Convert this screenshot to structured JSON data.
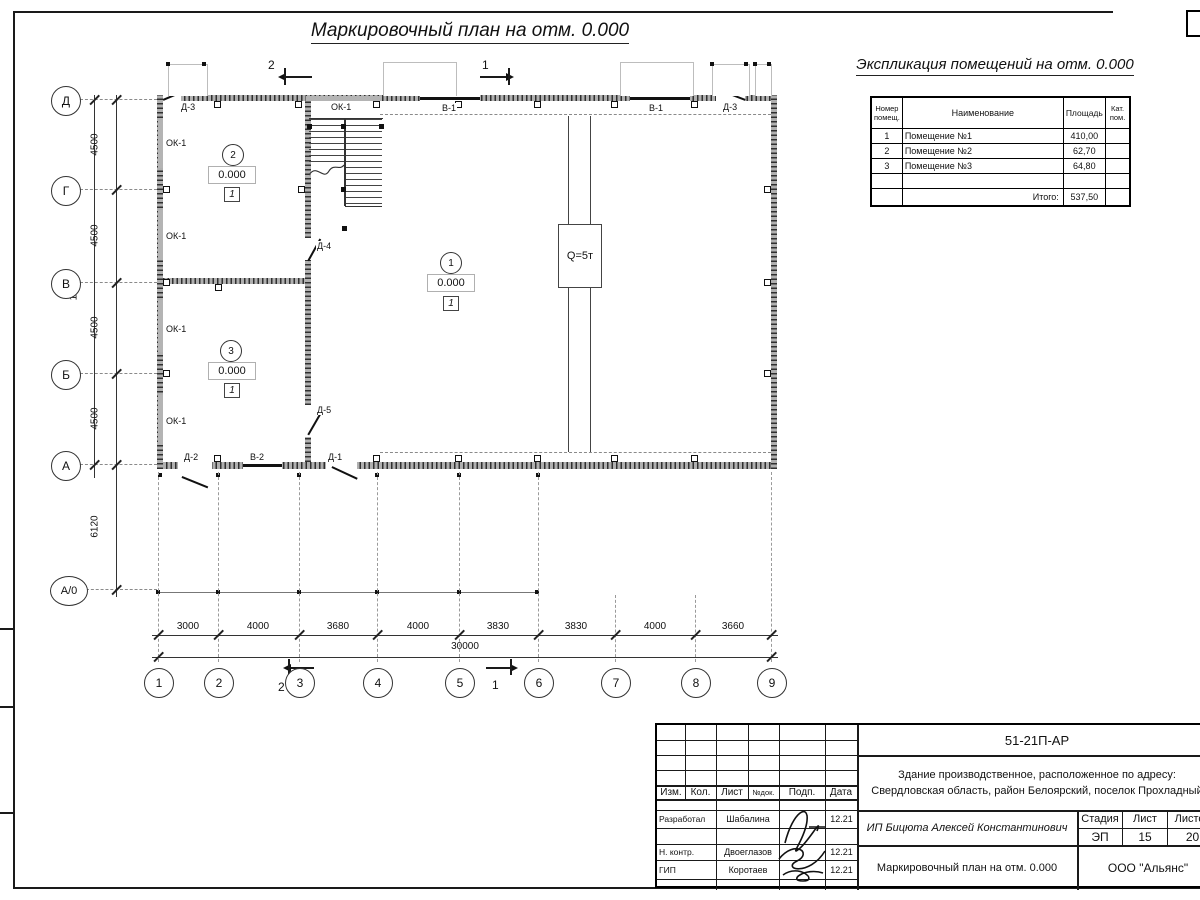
{
  "sheet": {
    "plan_title": "Маркировочный план на отм. 0.000",
    "explication_title": "Экспликация помещений на отм. 0.000"
  },
  "explication": {
    "headers": {
      "num": "Номер помещ.",
      "name": "Наименование",
      "area": "Площадь",
      "cat": "Кат. пом."
    },
    "rows": [
      {
        "num": "1",
        "name": "Помещение №1",
        "area": "410,00",
        "cat": ""
      },
      {
        "num": "2",
        "name": "Помещение №2",
        "area": "62,70",
        "cat": ""
      },
      {
        "num": "3",
        "name": "Помещение №3",
        "area": "64,80",
        "cat": ""
      },
      {
        "num": "",
        "name": "",
        "area": "",
        "cat": ""
      },
      {
        "num": "",
        "name": "Итого:",
        "area": "537,50",
        "cat": ""
      }
    ]
  },
  "plan": {
    "axes_vertical": [
      "Д",
      "Г",
      "В",
      "Б",
      "А",
      "А/0"
    ],
    "axes_horizontal": [
      "1",
      "2",
      "3",
      "4",
      "5",
      "6",
      "7",
      "8",
      "9"
    ],
    "dims_left": [
      "4500",
      "4500",
      "4500",
      "4500",
      "6120"
    ],
    "dim_left_total": "18000",
    "dims_bottom": [
      "3000",
      "4000",
      "3680",
      "4000",
      "3830",
      "3830",
      "4000",
      "3660"
    ],
    "dim_bottom_total": "30000",
    "crane_label": "Q=5т",
    "section_marks": {
      "s1": "1",
      "s2": "2"
    },
    "rooms": [
      {
        "number": "1",
        "elevation": "0.000",
        "category": "1"
      },
      {
        "number": "2",
        "elevation": "0.000",
        "category": "1"
      },
      {
        "number": "3",
        "elevation": "0.000",
        "category": "1"
      }
    ],
    "openings": {
      "ok1": "ОК-1",
      "v1": "В-1",
      "v2": "В-2",
      "d1": "Д-1",
      "d2": "Д-2",
      "d3": "Д-3",
      "d4": "Д-4",
      "d5": "Д-5"
    }
  },
  "titleblock": {
    "doc_number": "51-21П-АР",
    "project_description": "Здание производственное, расположенное по адресу: Свердловская область, район Белоярский, поселок Прохладный",
    "client": "ИП Бицюта Алексей Константинович",
    "sheet_title": "Маркировочный план на отм. 0.000",
    "company": "ООО \"Альянс\"",
    "stage_label": "Стадия",
    "sheet_label": "Лист",
    "sheets_label": "Листов",
    "stage": "ЭП",
    "sheet_no": "15",
    "sheets_total": "20",
    "cols": {
      "izm": "Изм.",
      "kol": "Кол.",
      "list": "Лист",
      "ndok": "№док.",
      "podp": "Подп.",
      "data": "Дата"
    },
    "roles": [
      {
        "role": "Разработал",
        "name": "Шабалина",
        "date": "12.21"
      },
      {
        "role": "Н. контр.",
        "name": "Двоеглазов",
        "date": "12.21"
      },
      {
        "role": "ГИП",
        "name": "Коротаев",
        "date": "12.21"
      }
    ]
  }
}
